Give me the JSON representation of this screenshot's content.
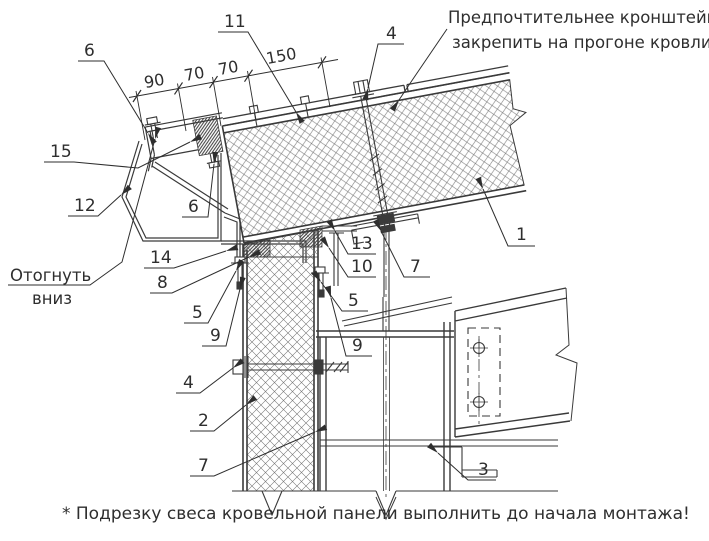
{
  "drawing": {
    "note_top": {
      "line1": "Предпочтительнее кронштейн",
      "line2": "закрепить на прогоне кровли"
    },
    "note_left": {
      "line1": "Отогнуть",
      "line2": "вниз"
    },
    "footnote": "* Подрезку свеса кровельной панели выполнить до начала монтажа!",
    "dimensions": {
      "d1": "90",
      "d2": "70",
      "d3": "70",
      "d4": "150"
    },
    "callouts": {
      "c6a": "6",
      "c11": "11",
      "c4top": "4",
      "c15": "15",
      "c12": "12",
      "c6b": "6",
      "c14": "14",
      "c8": "8",
      "c5l": "5",
      "c9l": "9",
      "c13": "13",
      "c10": "10",
      "c5r": "5",
      "c7r": "7",
      "c9r": "9",
      "c4b": "4",
      "c2": "2",
      "c7b": "7",
      "c3": "3",
      "c1": "1"
    }
  }
}
